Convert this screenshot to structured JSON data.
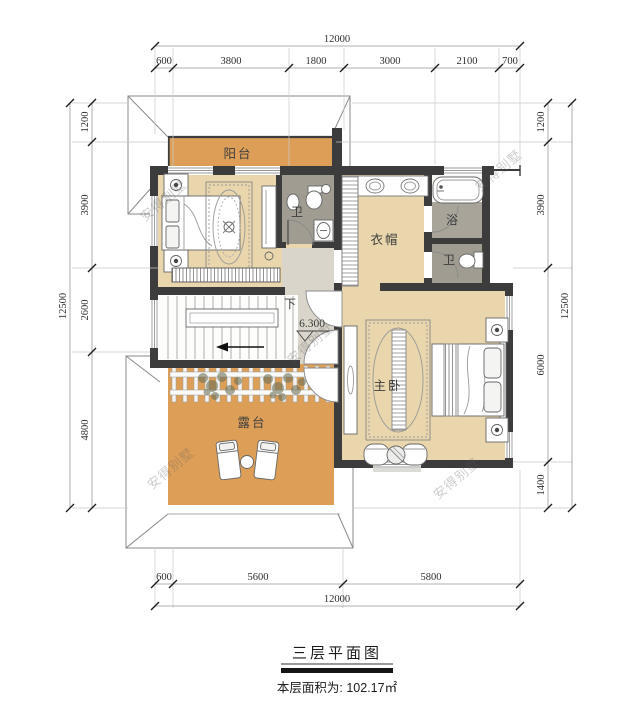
{
  "meta": {
    "title_label": "三层平面图",
    "area_note": "本层面积为: 102.17㎡"
  },
  "watermark": {
    "text": "安得别墅"
  },
  "rooms": {
    "balcony": "阳台",
    "bath_top": "卫",
    "cloakroom": "衣帽",
    "bath": "浴",
    "bath_small": "卫",
    "master_bedroom": "主卧",
    "terrace": "露台",
    "stair_down": "下",
    "elevation": "6.300"
  },
  "dimensions": {
    "top": {
      "total": "12000",
      "segments": [
        "600",
        "3800",
        "1800",
        "3000",
        "2100",
        "700"
      ]
    },
    "bottom": {
      "total": "12000",
      "segments": [
        "600",
        "5600",
        "5800"
      ]
    },
    "left": {
      "total": "12500",
      "segments": [
        "1200",
        "3900",
        "2600",
        "4800"
      ]
    },
    "right": {
      "total": "12500",
      "segments": [
        "1200",
        "3900",
        "6000",
        "1400"
      ]
    }
  },
  "colors": {
    "wall": "#3c3c3c",
    "balcony_floor": "#dd9f58",
    "room_floor": "#e9d6ac",
    "bath_floor": "#a09c92",
    "hall_floor": "#d9d5ca",
    "roof_line": "#8a8a8a"
  }
}
